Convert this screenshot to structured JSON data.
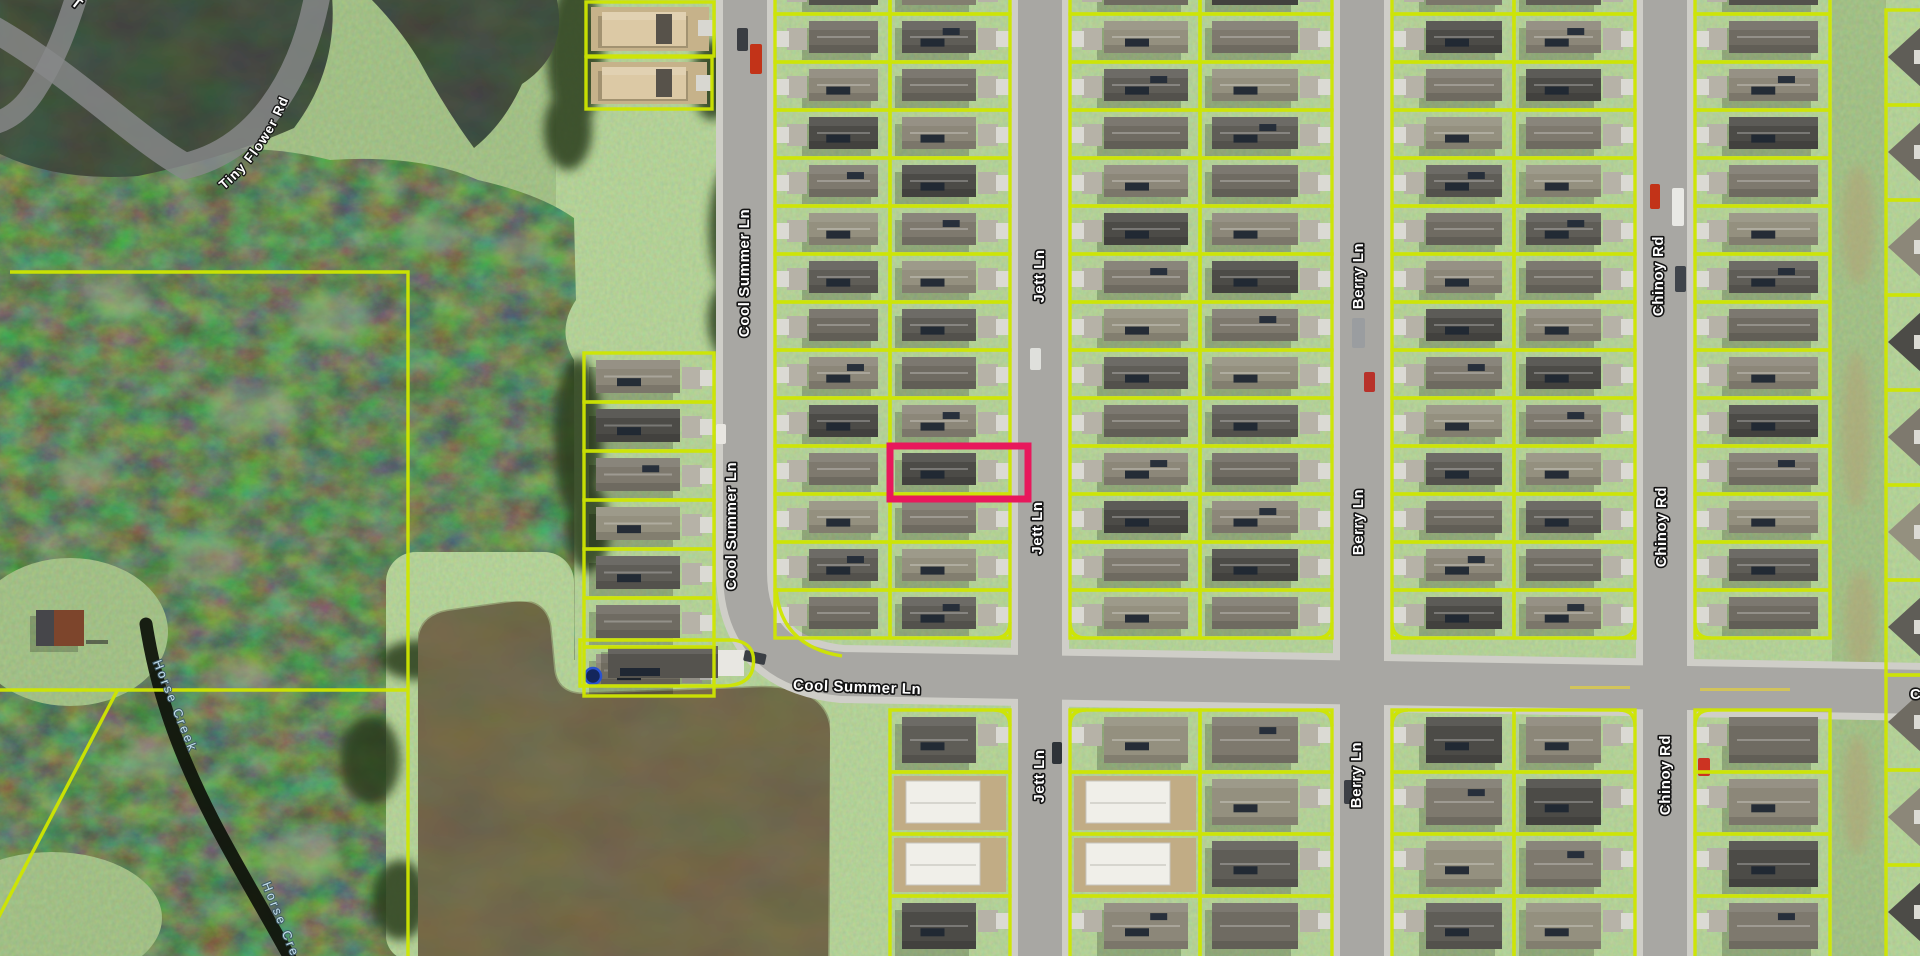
{
  "map": {
    "street_labels": {
      "tiny_flower_rd": "Tiny Flower Rd",
      "cool_summer_ln": "Cool Summer Ln",
      "jett_ln": "Jett Ln",
      "berry_ln": "Berry Ln",
      "chinoy_rd": "Chinoy Rd",
      "partial_top": "T",
      "partial_right": "C"
    },
    "water_labels": {
      "horse_creek": "Horse Creek"
    },
    "colors": {
      "parcel_line": "#cfe600",
      "parcel_highlight": "#e8185c",
      "street_label_fill": "#ffffff",
      "water_label_fill": "#cbe7f6"
    }
  }
}
